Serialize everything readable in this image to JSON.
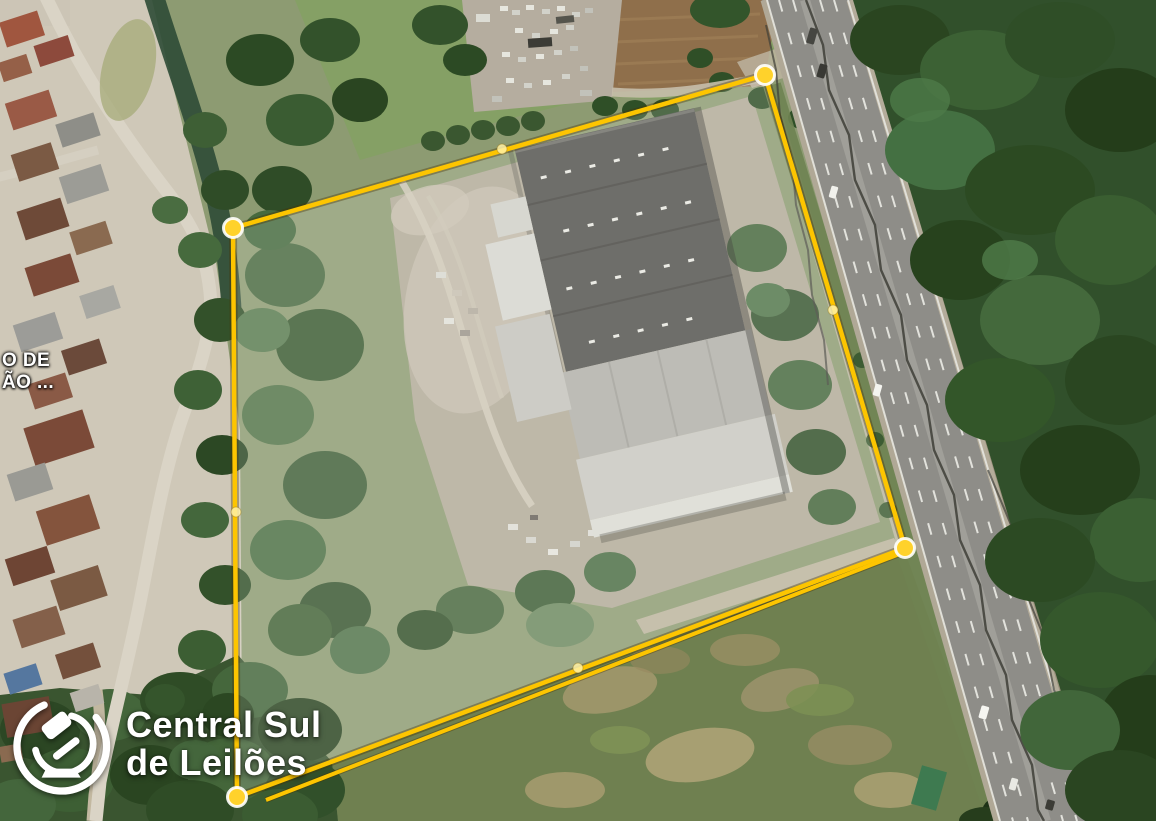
{
  "map_label": {
    "line1": "O DE",
    "line2": "ÃO ..."
  },
  "watermark": {
    "icon": "gavel-icon",
    "brand_line1": "Central Sul",
    "brand_line2": "de Leilões"
  },
  "parcel": {
    "outline_color": "#fdc500",
    "outline_shadow": "rgba(70,50,0,0.38)",
    "fill_tint": "rgba(255,255,255,0.16)",
    "points": "765,75 233,228 237,797 905,548",
    "secondary_edge_points": "266,800 902,553",
    "vertex_fill": "#ffd22b",
    "vertices": [
      {
        "x": 765,
        "y": 75
      },
      {
        "x": 233,
        "y": 228
      },
      {
        "x": 237,
        "y": 797
      },
      {
        "x": 905,
        "y": 548
      }
    ],
    "midpoint_fill": "rgba(255,241,166,0.85)",
    "midpoints": [
      {
        "x": 502,
        "y": 149
      },
      {
        "x": 236,
        "y": 512
      },
      {
        "x": 578,
        "y": 668
      },
      {
        "x": 833,
        "y": 310
      }
    ]
  }
}
